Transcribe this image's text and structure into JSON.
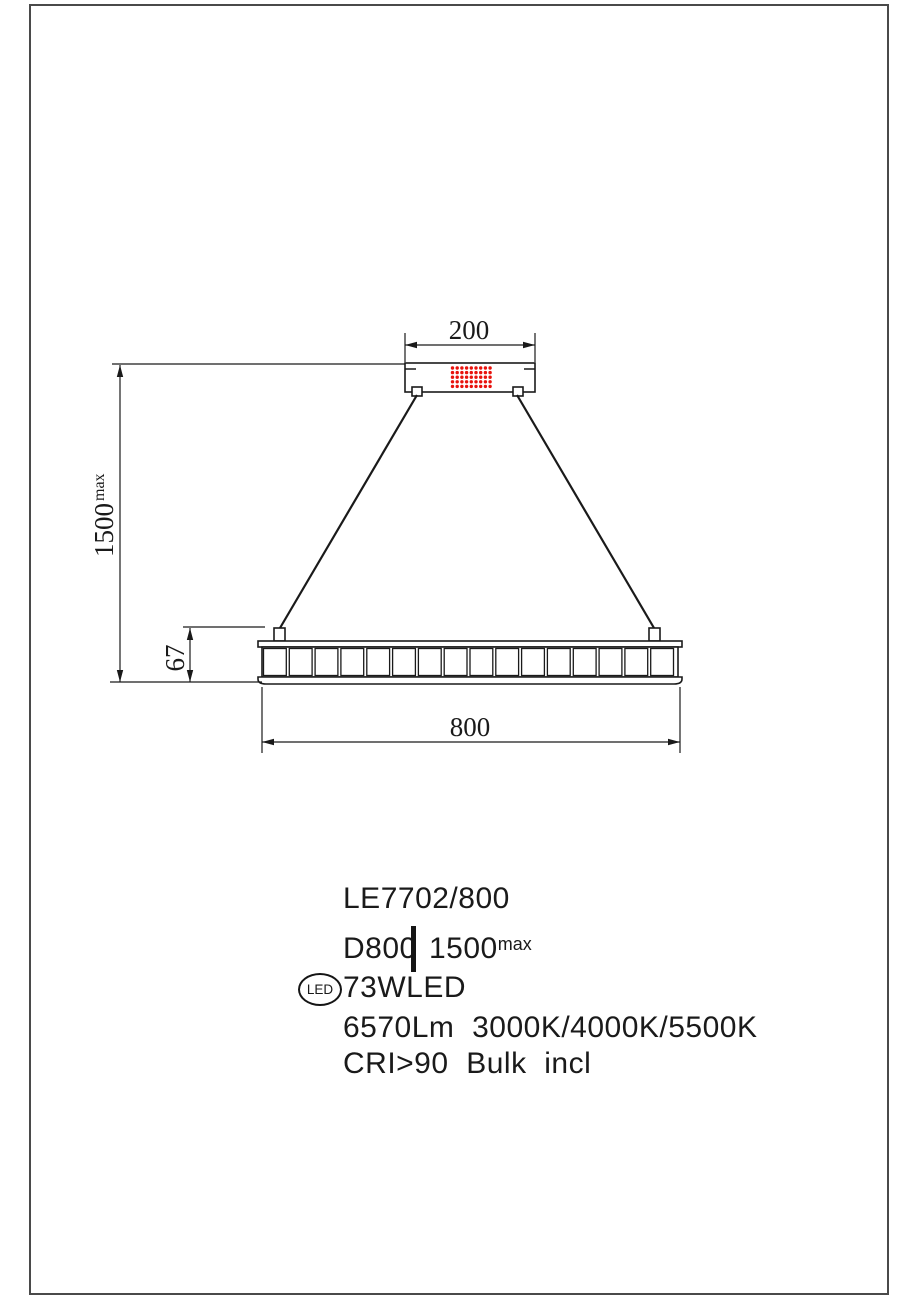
{
  "title": "LE7702/800 pendant luminaire dimension drawing",
  "colors": {
    "line": "#1a1a1a",
    "accent_red": "#e8120c",
    "frame": "#4a4a4a"
  },
  "drawing": {
    "dimensions": {
      "canopy_width": "200",
      "suspension_height": "1500",
      "suspension_height_sup": "max",
      "body_height": "67",
      "diameter": "800"
    },
    "driver_dots": {
      "rows": 5,
      "cols": 9,
      "color": "#e8120c"
    },
    "ring_segments": 16
  },
  "specs": {
    "model": "LE7702/800",
    "diameter_label": "D800",
    "height_value": "1500",
    "height_sup": "max",
    "led_badge": "LED",
    "wattage": "73WLED",
    "output_line": "6570Lm  3000K/4000K/5500K",
    "cri_line": "CRI>90  Bulk  incl"
  }
}
